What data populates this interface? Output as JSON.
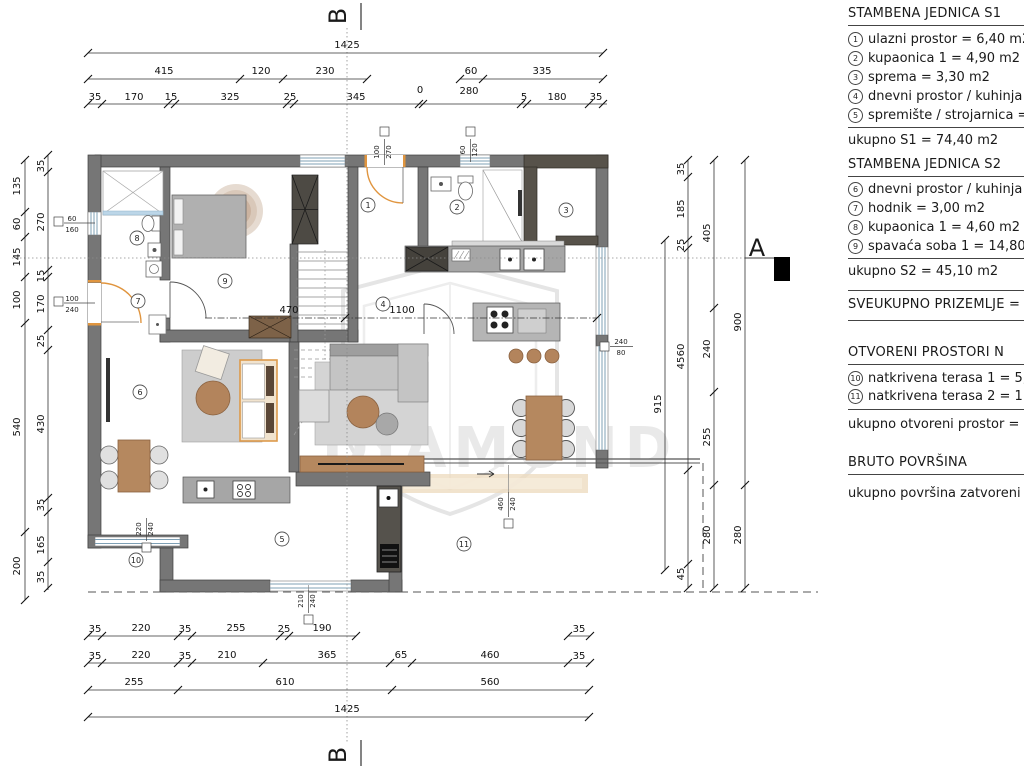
{
  "markers": {
    "a": "A",
    "b_top": "B",
    "b_bottom": "B"
  },
  "watermark": {
    "text": "DIAMOND"
  },
  "rooms": [
    "1",
    "2",
    "3",
    "4",
    "5",
    "6",
    "7",
    "8",
    "9",
    "10",
    "11"
  ],
  "dims": {
    "top": {
      "row1": [
        "1425"
      ],
      "row2": [
        "415",
        "120",
        "230",
        "60",
        "335"
      ],
      "row3": [
        "35",
        "170",
        "15",
        "325",
        "25",
        "345",
        "0",
        "280",
        "5",
        "180",
        "35"
      ]
    },
    "bottom": {
      "row1": [
        "35",
        "220",
        "35",
        "255",
        "25",
        "190",
        "35"
      ],
      "row2": [
        "35",
        "220",
        "35",
        "210",
        "365",
        "65",
        "460",
        "35"
      ],
      "row3": [
        "255",
        "610",
        "560"
      ],
      "row4": [
        "1425"
      ]
    },
    "left": {
      "outer": [
        "135",
        "60",
        "145",
        "100",
        "540",
        "200"
      ],
      "inner": [
        "35",
        "270",
        "15",
        "170",
        "25",
        "430",
        "35",
        "165",
        "35"
      ]
    },
    "right": {
      "col1": [
        "915"
      ],
      "col2": [
        "35",
        "185",
        "25",
        "60",
        "45",
        "45"
      ],
      "col3": [
        "405",
        "240",
        "255",
        "280"
      ],
      "col4": [
        "900",
        "280"
      ]
    },
    "inner": [
      "470",
      "1100"
    ]
  },
  "tags": [
    {
      "w": "60",
      "h": "160"
    },
    {
      "w": "100",
      "h": "240"
    },
    {
      "w": "100",
      "h": "270"
    },
    {
      "w": "60",
      "h": "120"
    },
    {
      "w": "240",
      "h": "80"
    },
    {
      "w": "460",
      "h": "240"
    },
    {
      "w": "220",
      "h": "240"
    },
    {
      "w": "210",
      "h": "240"
    }
  ],
  "legend": {
    "s1_title": "STAMBENA JEDNICA S1",
    "s1_items": [
      {
        "n": "1",
        "t": "ulazni prostor = 6,40 m2"
      },
      {
        "n": "2",
        "t": "kupaonica 1 = 4,90 m2"
      },
      {
        "n": "3",
        "t": "sprema = 3,30 m2"
      },
      {
        "n": "4",
        "t": "dnevni prostor / kuhinja = 5"
      },
      {
        "n": "5",
        "t": "spremište / strojarnica = 9,8"
      }
    ],
    "s1_total": "ukupno S1 = 74,40 m2",
    "s2_title": "STAMBENA JEDNICA S2",
    "s2_items": [
      {
        "n": "6",
        "t": "dnevni prostor / kuhinja = 2"
      },
      {
        "n": "7",
        "t": "hodnik = 3,00 m2"
      },
      {
        "n": "8",
        "t": "kupaonica 1 = 4,60 m2"
      },
      {
        "n": "9",
        "t": "spavaća soba 1 = 14,80 m2"
      }
    ],
    "s2_total": "ukupno S2 = 45,10 m2",
    "ground_total": "SVEUKUPNO PRIZEMLJE =",
    "open_title": "OTVORENI PROSTORI N",
    "open_items": [
      {
        "n": "10",
        "t": "natkrivena terasa 1 = 5,10 m"
      },
      {
        "n": "11",
        "t": "natkrivena terasa 2 = 11,30"
      }
    ],
    "open_total": "ukupno otvoreni prostor = 16,4",
    "bruto_title": "BRUTO POVRŠINA",
    "bruto_text": "ukupno površina zatvoreni pro"
  }
}
